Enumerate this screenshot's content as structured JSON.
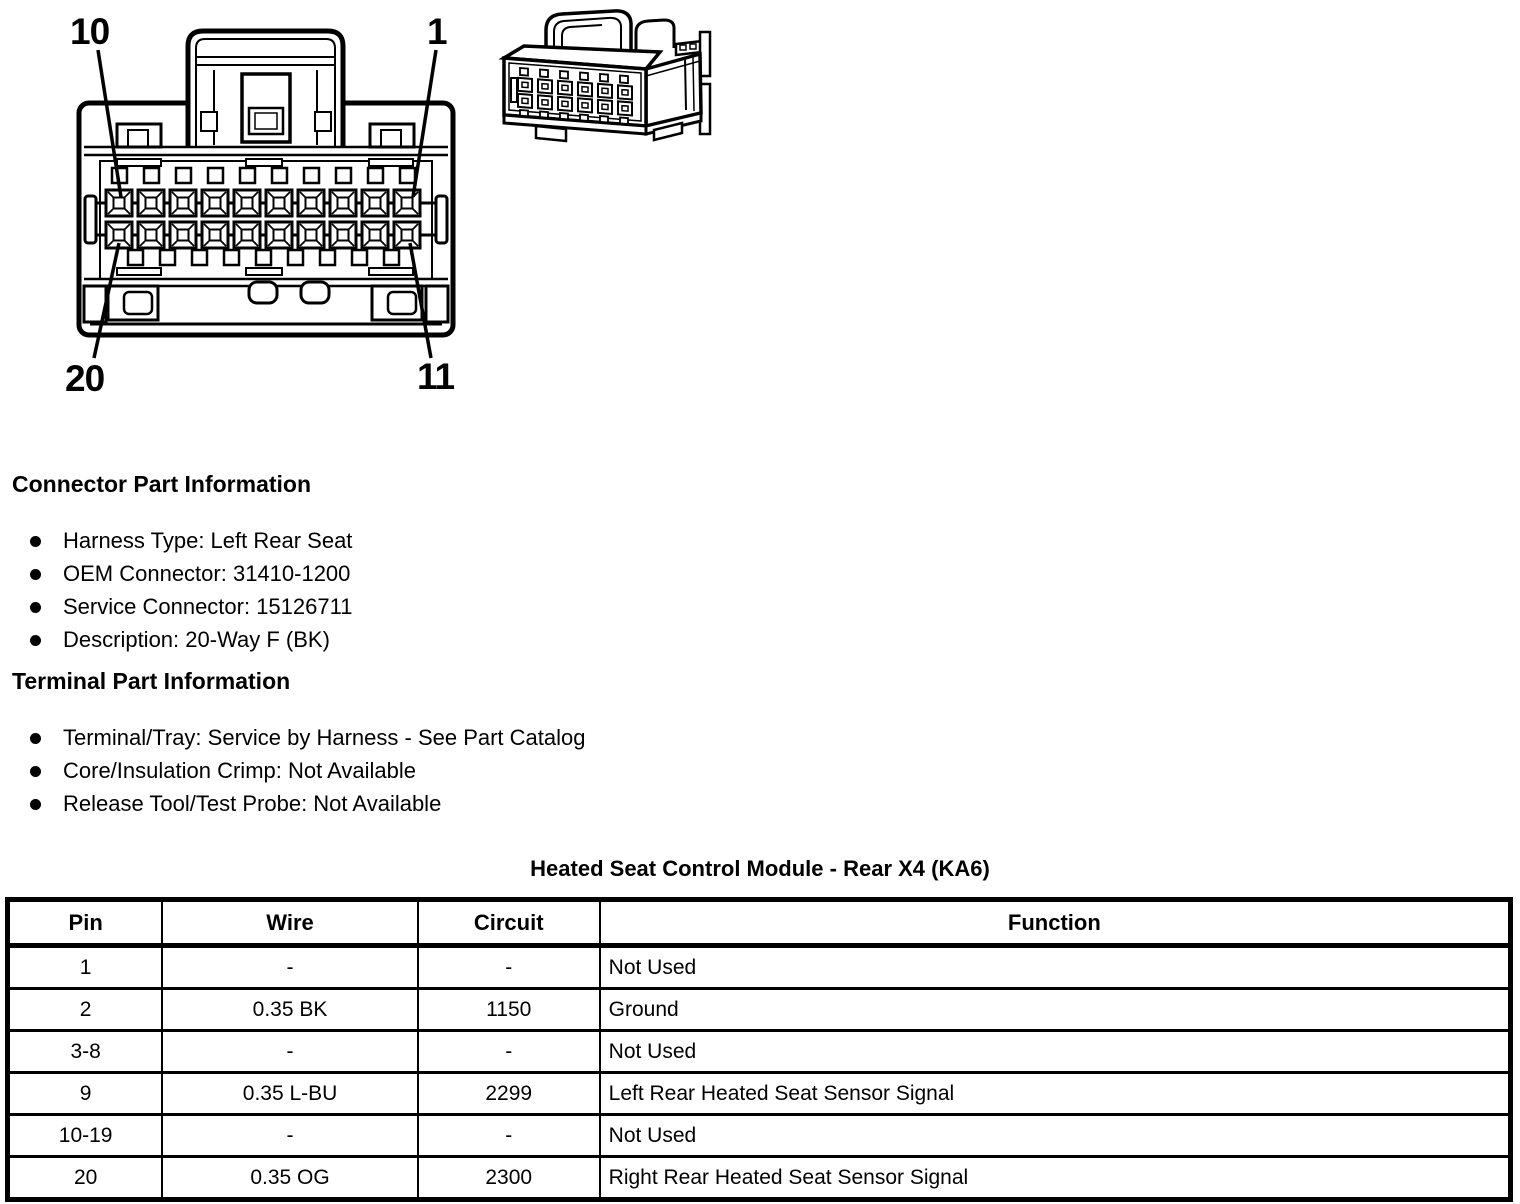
{
  "diagram": {
    "pin_labels": [
      "10",
      "1",
      "20",
      "11"
    ]
  },
  "connector_info": {
    "heading": "Connector Part Information",
    "items": [
      "Harness Type: Left Rear Seat",
      "OEM Connector: 31410-1200",
      "Service Connector: 15126711",
      "Description: 20-Way F (BK)"
    ]
  },
  "terminal_info": {
    "heading": "Terminal Part Information",
    "items": [
      "Terminal/Tray: Service by Harness - See Part Catalog",
      "Core/Insulation Crimp: Not Available",
      "Release Tool/Test Probe: Not Available"
    ]
  },
  "table": {
    "title": "Heated Seat Control Module - Rear X4 (KA6)",
    "columns": [
      "Pin",
      "Wire",
      "Circuit",
      "Function"
    ],
    "rows": [
      [
        "1",
        "-",
        "-",
        "Not Used"
      ],
      [
        "2",
        "0.35 BK",
        "1150",
        "Ground"
      ],
      [
        "3-8",
        "-",
        "-",
        "Not Used"
      ],
      [
        "9",
        "0.35 L-BU",
        "2299",
        "Left Rear Heated Seat Sensor Signal"
      ],
      [
        "10-19",
        "-",
        "-",
        "Not Used"
      ],
      [
        "20",
        "0.35 OG",
        "2300",
        "Right Rear Heated Seat Sensor Signal"
      ]
    ]
  }
}
